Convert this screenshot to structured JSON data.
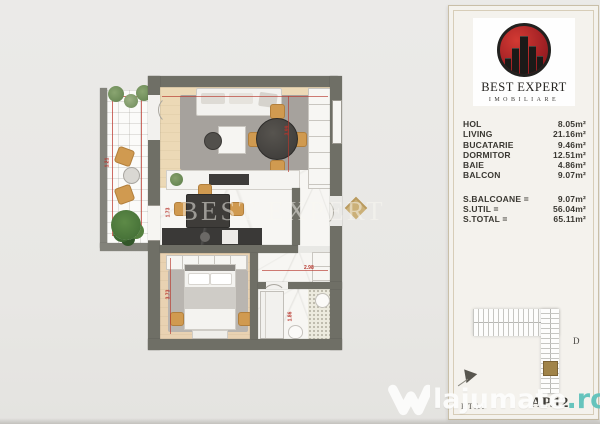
{
  "colors": {
    "wall": "#6f6f66",
    "logo_red": "#a02024",
    "accent_tan": "#d09a50",
    "watermark_teal": "#5fc2bb"
  },
  "brand": {
    "name": "BEST EXPERT",
    "subtitle": "IMOBILIARE"
  },
  "areas": {
    "rooms": [
      {
        "label": "HOL",
        "value": "8.05m²"
      },
      {
        "label": "LIVING",
        "value": "21.16m²"
      },
      {
        "label": "BUCATARIE",
        "value": "9.46m²"
      },
      {
        "label": "DORMITOR",
        "value": "12.51m²"
      },
      {
        "label": "BAIE",
        "value": "4.86m²"
      },
      {
        "label": "BALCON",
        "value": "9.07m²"
      }
    ],
    "totals": [
      {
        "label": "S.BALCOANE =",
        "value": "9.07m²"
      },
      {
        "label": "S.UTIL =",
        "value": "56.04m²"
      },
      {
        "label": "S.TOTAL =",
        "value": "65.11m²"
      }
    ]
  },
  "keyplan": {
    "block_label": "D"
  },
  "footer": {
    "floor_label": "ETAJ",
    "apartment_label": "AP.12"
  },
  "watermark": {
    "text": "lajumate",
    "tld": ".ro"
  },
  "floor_plan": {
    "ghost_watermark": "BEST EXPERT",
    "dims": [
      "1.21",
      "3.99",
      "1.73",
      "3.73",
      "2.98",
      "1.86"
    ]
  }
}
